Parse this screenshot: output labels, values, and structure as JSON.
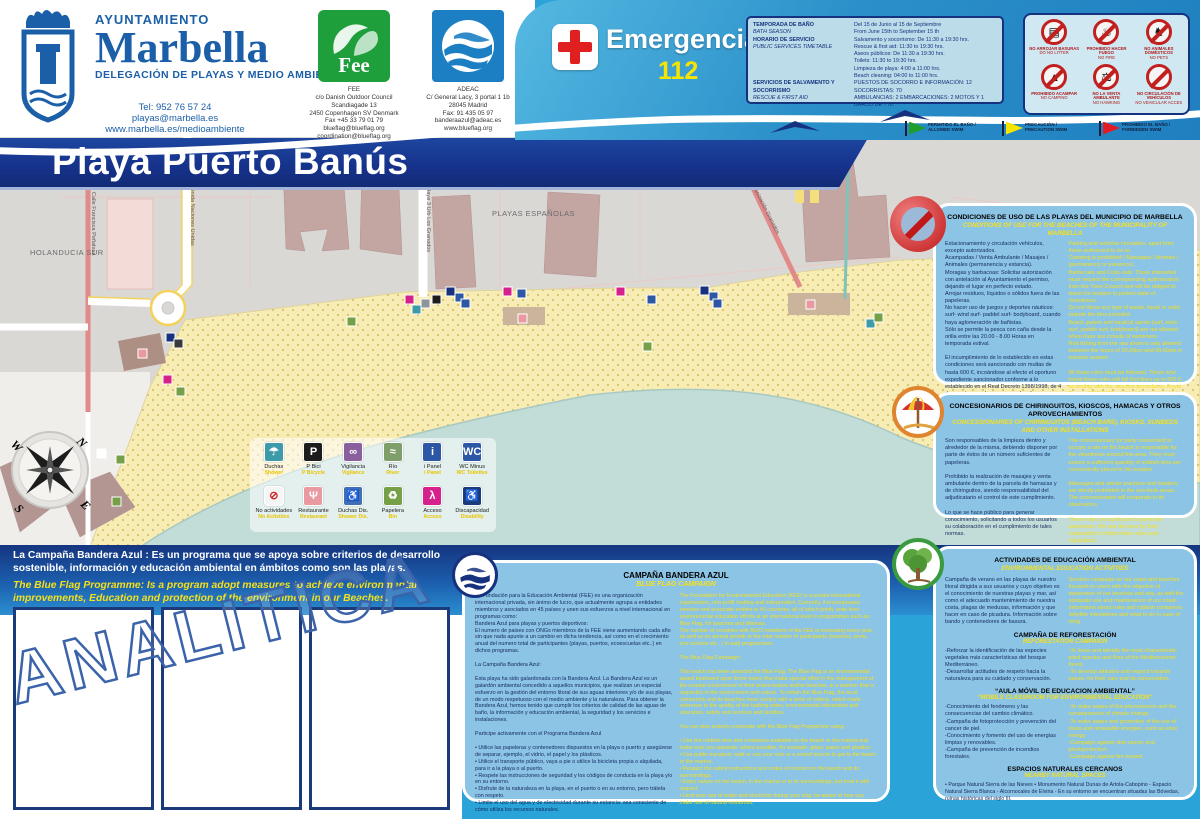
{
  "colors": {
    "page_cyan": "#2aa4d8",
    "banner_blue": "#16328a",
    "panel_blue": "#8cc4e6",
    "navy_text": "#14295c",
    "yellow_text": "#f5e01a",
    "sand": "#f7ecb4",
    "sea": "#c2ddd8",
    "urban_gray": "#d9d8d5",
    "prohibition_red": "#c21f1f"
  },
  "header": {
    "marbella": {
      "org": "AYUNTAMIENTO",
      "name": "Marbella",
      "dept": "DELEGACIÓN DE PLAYAS Y MEDIO AMBIENTE",
      "contact": "Tel: 952 76 57 24\nplayas@marbella.es\nwww.marbella.es/medioambiente"
    },
    "fee": {
      "name": "Fee",
      "address": "FEE\nc/o Danish Outdoor Council\nScandiagade 13\n2450 Copenhagen SV Denmark\nFax +45 33 79 01 79\nblueflag@blueflag.org\ncoordination@blueflag.org"
    },
    "adeac": {
      "address": "ADEAC\nC/ General Lacy, 3 portal 1 1b\n28045 Madrid\nFax: 91 435 05 97\nbanderaazul@adeac.es\nwww.blueflag.org"
    },
    "emergency": {
      "label": "Emergencias",
      "number": "112"
    },
    "schedule": {
      "rows": [
        {
          "es": "TEMPORADA DE BAÑO",
          "en": "BATH SEASON",
          "value": "Del 15 de Junio al 15 de Septiembre\nFrom June 15th to September 15 th"
        },
        {
          "es": "HORARIO DE SERVICIO",
          "en": "PUBLIC SERVICES TIMETABLE",
          "value": "Salvamento y socorrismo: De 11:30 a 19:30 hrs.\nRescue & first aid: 11:30 to 19:30 hrs.\nAseos públicos: De 11:30 a 19:30 hrs.\nToilets: 11:30 to 19:30 hrs.\nLimpieza de playa: 4:00 a 11:00 hrs.\nBeach cleaning: 04:00 to 11:00 hrs."
        },
        {
          "es": "SERVICIOS DE SALVAMENTO Y SOCORRISMO",
          "en": "RESCUE & FIRST AID",
          "value": "PUESTOS DE SOCORRO E INFORMACIÓN: 12\nSOCORRISTAS: 70\nAMBULANCIAS: 2 EMBARCACIONES: 2 MOTOS Y 1 BARCO DE 7 m."
        }
      ]
    },
    "prohibitions": [
      {
        "es": "NO ARROJAR BASURAS",
        "en": "DO NO LITTER",
        "glyph": "▤"
      },
      {
        "es": "PROHIBIDO HACER FUEGO",
        "en": "NO FIRE",
        "glyph": "♨"
      },
      {
        "es": "NO ANIMALES DOMÉSTICOS",
        "en": "NO PETS",
        "glyph": "♞"
      },
      {
        "es": "PROHIBIDO ACAMPAR",
        "en": "NO CAMPING",
        "glyph": "▲"
      },
      {
        "es": "NO LA VENTA AMBULANTE",
        "en": "NO HAWKING",
        "glyph": "⚖"
      },
      {
        "es": "NO CIRCULACIÓN DE VEHÍCULOS",
        "en": "NO VEHICULAR ACCES",
        "glyph": ""
      }
    ],
    "flags": [
      {
        "label": "PERMITIDO EL BAÑO / ALLOWED SWIM",
        "color": "#1f9e2c"
      },
      {
        "label": "PRECAUCIÓN / PRECAUTION SWIM",
        "color": "#f7e500"
      },
      {
        "label": "PROHIBIDO EL BAÑO / FORBIDDEN SWIM",
        "color": "#e31c24"
      }
    ]
  },
  "banner": {
    "title": "Playa Puerto Banús"
  },
  "map": {
    "labels": {
      "area_left": "HOLANDUCIA SUR",
      "area_center": "PLAYAS ESPAÑOLAS",
      "street_1": "Calle Francisca Peñalosa",
      "street_2": "Avenida Naciones Unidas",
      "street_3": "Calle Playa 3 Urb Los Granados",
      "street_4": "Urbanización Granados"
    },
    "compass": {
      "n": "N",
      "e": "E",
      "s": "S",
      "w": "W"
    },
    "legend": {
      "items": [
        {
          "label": "Duchas",
          "en": "Shower",
          "color": "#3d9aa8",
          "fg": "#ffffff",
          "glyph": "☂"
        },
        {
          "label": "P Bici",
          "en": "P Bicycle",
          "color": "#1c1c1c",
          "fg": "#ffffff",
          "glyph": "P"
        },
        {
          "label": "Vigilancia",
          "en": "Vigilance",
          "color": "#8a5f9e",
          "fg": "#ffffff",
          "glyph": "∞"
        },
        {
          "label": "Río",
          "en": "River",
          "color": "#7e9e6a",
          "fg": "#ffffff",
          "glyph": "≈"
        },
        {
          "label": "i Panel",
          "en": "i Panel",
          "color": "#2b57a5",
          "fg": "#ffffff",
          "glyph": "i"
        },
        {
          "label": "WC Minus",
          "en": "WC Toilettes",
          "color": "#2b57a5",
          "fg": "#ffffff",
          "glyph": "WC"
        },
        {
          "label": "No actividades",
          "en": "No Activities",
          "color": "#f5f5f5",
          "fg": "#d22020",
          "glyph": "⊘"
        },
        {
          "label": "Restaurante",
          "en": "Restaurant",
          "color": "#e89aa0",
          "fg": "#ffffff",
          "glyph": "Ψ"
        },
        {
          "label": "Duchas Dis.",
          "en": "Shower Dis.",
          "color": "#3f6fb5",
          "fg": "#ffffff",
          "glyph": "♿"
        },
        {
          "label": "Papelera",
          "en": "Bin",
          "color": "#76a048",
          "fg": "#ffffff",
          "glyph": "♻"
        },
        {
          "label": "Acceso",
          "en": "Access",
          "color": "#d6218c",
          "fg": "#ffffff",
          "glyph": "λ"
        },
        {
          "label": "Discapacidad",
          "en": "Disability",
          "color": "#1b3a7a",
          "fg": "#ffffff",
          "glyph": "♿"
        }
      ]
    },
    "icons": [
      [
        405,
        158,
        "#d6218c"
      ],
      [
        412,
        168,
        "#3d9aa8"
      ],
      [
        421,
        162,
        "#8d949c"
      ],
      [
        432,
        158,
        "#1c1c1c"
      ],
      [
        446,
        150,
        "#16327e"
      ],
      [
        455,
        156,
        "#2b57a5"
      ],
      [
        461,
        162,
        "#2b57a5"
      ],
      [
        503,
        150,
        "#d6218c"
      ],
      [
        517,
        152,
        "#2b57a5"
      ],
      [
        616,
        150,
        "#d6218c"
      ],
      [
        647,
        158,
        "#2b57a5"
      ],
      [
        700,
        149,
        "#16327e"
      ],
      [
        709,
        155,
        "#2b57a5"
      ],
      [
        713,
        162,
        "#2b57a5"
      ],
      [
        643,
        205,
        "#76a048"
      ],
      [
        866,
        182,
        "#3d9aa8"
      ],
      [
        874,
        176,
        "#76a048"
      ],
      [
        518,
        177,
        "#e89aa0"
      ],
      [
        806,
        163,
        "#e89aa0"
      ],
      [
        138,
        212,
        "#e89aa0"
      ],
      [
        166,
        196,
        "#16327e"
      ],
      [
        174,
        202,
        "#3a3a3a"
      ],
      [
        163,
        238,
        "#d6218c"
      ],
      [
        176,
        250,
        "#76a048"
      ],
      [
        347,
        180,
        "#76a048"
      ],
      [
        97,
        312,
        "#ffffff"
      ],
      [
        116,
        318,
        "#76a048"
      ],
      [
        112,
        360,
        "#76a048"
      ]
    ]
  },
  "panels": {
    "conditions": {
      "title": "CONDICIONES DE USO DE LAS PLAYAS DEL MUNICIPIO DE MARBELLA",
      "subtitle": "CONDITIONS OF USE FOR THE BEACHES OF THE MUNICIPALITY OF MARBELLA",
      "es": "Estacionamiento y circulación vehículos, excepto autorizados.\nAcampadas / Venta Ambulante / Masajes / Animales (permanencia y estancia).\nMoragas y barbacoas: Solicitar autorización con antelación al Ayuntamiento el permiso, dejando el lugar en perfecto estado.\nArrojar residuos, líquidos o sólidos fuera de las papeleras.\nNo hacer uso de juegos y deportes náuticos: surf- wind surf- paddel surf- bodyboard, cuando haya aglomeración de bañistas.\nSólo se permite la pesca con caña desde la orilla entre las 20.00 - 8.00 Horas en temporada estival.\n\nEl incumplimiento de lo establecido en estas condiciones será sancionado con multas de hasta 600 €, incoándose al efecto el oportuno expediente sancionador conforme a lo establecido en el Real Decreto 1398/1998, de 4 de agosto, por el que se aprueba el Reglamento del Procedimiento para el ejercicio de la Potestad Sancionadora.",
      "en": "Parking and vehicles circulation, apart from those authorised to do so.\nCamping is prohibited / Massages / Animals / (permanency or presence).\nBarbecues and Cook-outs: Those interested must request the corresponding authorisation from the Town Council and will be obliged to leave the location in perfect state of cleanliness.\nDo not throw any type of waste, liquid or solid, outside the bins provided.\nBeach games and nautical sports (surf, wind surf, paddle surf, bodyboard) are not allowed when there are crowds of swimmers.\nRod fishing from the sea shore is only allowed between the hours of 20.00pm and 08.00am in summer season.\n\nAll these rules must be followed. Those who break these rules will fall foul fines up to 600 €, according with the sanction procedures, Royal Decree 1398/1998, of 4th of August, by which the legal sanction to these conditions was approved."
    },
    "concessions": {
      "title": "CONCESIONARIOS DE CHIRINGUITOS, KIOSCOS, HAMACAS Y OTROS APROVECHAMIENTOS",
      "subtitle": "CONCESSIONARIES OF CHIRINGUITOS (BEACH BARS), KIOSKS, SUNBEDS AND OTHER INSTALLATIONS",
      "es": "Son responsables de la limpieza dentro y alrededor de la misma, debiendo disponer por parte de éstos de un número suficientes de papeleras.\n\nProhibido la realización de masajes y venta ambulante dentro de la parcela de hamacas y de chiringuitos, siendo responsabilidad del adjudicatario el control de este cumplimiento.\n\nLo que se hace público para generar conocimiento, solicitando a todos los usuarios su colaboración en el cumplimiento de tales normas.",
      "en": "The concessionary (or party concerned) to occupy a site on the beach is responsible for the cleanliness around this area. They must ensure a sufficient quantity of rubbish bins are conveniently placed in the location.\n\nMassages and similar practices and hawkers are strictly prohibited in the sun-beds areas. The concessionaire will cooperate in its observance.\n\nThese rules are publicised to generate awareness. We ask all users by their cooperation to follow these rules and regulations."
    },
    "education": {
      "title": "ACTIVIDADES DE EDUCACIÓN AMBIENTAL",
      "subtitle": "ENVIRONMENTAL EDUCATION ACTIVITIES",
      "intro_es": "Campaña de verano en las playas de nuestro litoral dirigida a sus usuarios y cuyo objetivo es el conocimiento de nuestras playas y mar, así como el adecuado mantenimiento de nuestra costa, plagas de medusas, información y que hacer en caso de picadura. Información sobre bando y contenedores de basura.",
      "intro_en": "Summer campaign on our coast and beaches focused on users with the objective of awareness of our beaches and sea, as well the adequate use and maintenance of our coast. Information about rules and rubbish containers. Jellyfish infestations and what to do in case of sting.",
      "reforest_title": "CAMPAÑA DE REFORESTACIÓN",
      "reforest_sub": "REFORESTATION CAMPAIGN",
      "reforest_es": "-Reforzar la identificación de las especies vegetales más características del bosque Mediterráneo.\n-Desarrollar actitudes de respeto hacia la naturaleza para su cuidado y conservación.",
      "reforest_en": "-To know and identify the most characteristic plant species and flora of the Mediterranean forest.\n-To develop attitudes and respect towards nature, for their care and its conservation.",
      "aula_title": "“AULA MÓVIL DE EDUCACION AMBIENTAL”",
      "aula_sub": "“MOBILE CLASSROOM FOR ENVIRONMENTAL EDUCATION”",
      "aula_es": "-Conocimiento del fenómeno y las consecuencias del cambio climático.\n-Campaña de fotoprotección y prevención del cancer de piel.\n-Conocimiento y fomento del uso de energías limpias y renovables.\n-Campaña de prevención de incendios forestales.",
      "aula_en": "-To make aware of the phenomenon and the consequences of climate change.\n-To make aware and promotion of the use of clean and renewable energies, such as solar energy.\n-Campaign against skin cancer and photoprotection.\n-Campaign against fire hazard.",
      "spaces_title": "ESPACIOS NATURALES CERCANOS",
      "spaces_sub": "NEARBY NATURAL SPACES",
      "spaces_es": "• Parque Natural Sierra de las Nieves • Monumento Natural Dunas de Artola-Cabopino - Espacio Natural Sierra Blanca - Alcornocales de Elviria - En su entorno se encuentran situadas las Bóvedas, ruinas históricas del siglo III."
    }
  },
  "band": {
    "es": "La Campaña Bandera Azul :  Es un programa que se apoya sobre criterios de desarrollo sostenible, información y educación ambiental en ámbitos como son las playas.",
    "en": "The Blue Flag Programme: Is a program adopt measures to achieve environmental improvements, Education and protection of the environment in our Beaches."
  },
  "campaign": {
    "title": "CAMPAÑA BANDERA AZUL",
    "subtitle": "BLUE FLAG CAMPAIGN",
    "es": "La Fundación para la Educación Ambiental (FEE) es una organización internacional privada, sin ánimo de lucro, que actualmente agrupa a entidades miembros y asociados en 45 países y unen sus esfuerzos a nivel internacional en programas como:\nBandera Azul para playas y puertos deportivos:\nEl numero de paises con ONGs miembros de la FEE viene aumentando cada año sin que nada apunte a un cambio en dicha tendencia, así como en el crecimiento anual del numero total de participantes (playas, puertos, ecoescuelas etc..) en dichos programas.\n\nLa Campaña Bandera Azul:\n\nEsta playa ha sido galardonada con la Bandera Azul. La Bandera Azul es un galardón ambiental concedido a aquellos municipios, que realizan un especial esfuerzo en la gestión del entorno litoral de sus aguas interiores y/o de sus playas, de un modo respetuoso con el medio ambiente y la naturaleza. Para obtener la Bandera Azul, hemos tenido que cumplir los criterios de calidad de las aguas de baño, la información y educación ambiental, la seguridad y los servicios e instalaciones.\n\nParticipe activamente con el Programa Bandera Azul\n\n• Utilice las papeleras y contenedores dispuestos en la playa o puerto y asegúrese de separar, ejemplo, el vidrio, el papel y los plásticos.\n• Utilice el transporte público, vaya a pie o utilice la bicicleta propia o alquilada, para ir a la playa o al puerto.\n• Respete las instrucciones de seguridad y los códigos de conducta en la playa y/o en su entorno.\n• Disfrute de la naturaleza en la playa, en el puerto o en su entorno, pero trátela con respeto.\n• Limite el uso del agua y de electricidad durante su estancia: sea consciente de cómo utiliza los recursos naturales.",
    "en": "The Foundation for Environmental Education (FEE) is a private international organisation, non-profit making and independent. Currently, it encompasses member and associate entities in 45 countries, all of which jointly unite their environmental education efforts at an international level in programmes such as:\nBlue Flag, for beaches and Marinas.\nThe number of countries with NGO members of the FEE is increasing every year, as well as an annual growth in the total number of participants (beaches, ports, eco-schools etc...) in said programmes.\n\nThe Blue Flag Campaign:\n\nThis beach has been awarded the Blue Flag. The Blue Flag is an environmental award bestowed upon those towns that make special effort in the management of the coastal environment of their inland waters and/or beaches, in a manner that is respectful of the environment and nature. To obtain the Blue Flag, the local community and its beaches must comply with a serie of criteria, which made reference to the quality of the bathing water, environmental information and education, safety and services and facilities.\n\nYou can also actively cooperate with the Blue Flag Programme using:\n\n• Use the rubbish bins and containers available on the beach or the marina and make sure you separate, where possible, for example, glass, paper and plastics.\n• Use public transport, walk or use your own or a rented bicycle to get to the beach or the marina.\n• Respect the safety instructions and codes of conduct on the beach and its surroundings.\n• Enjoy nature on the beach, in the marina or in its surroundings, but treat it with respect.\n• Limit your use of water and electricity during your stay, be aware of how you make use of natural resources."
  },
  "watermark": "ANALITICA"
}
